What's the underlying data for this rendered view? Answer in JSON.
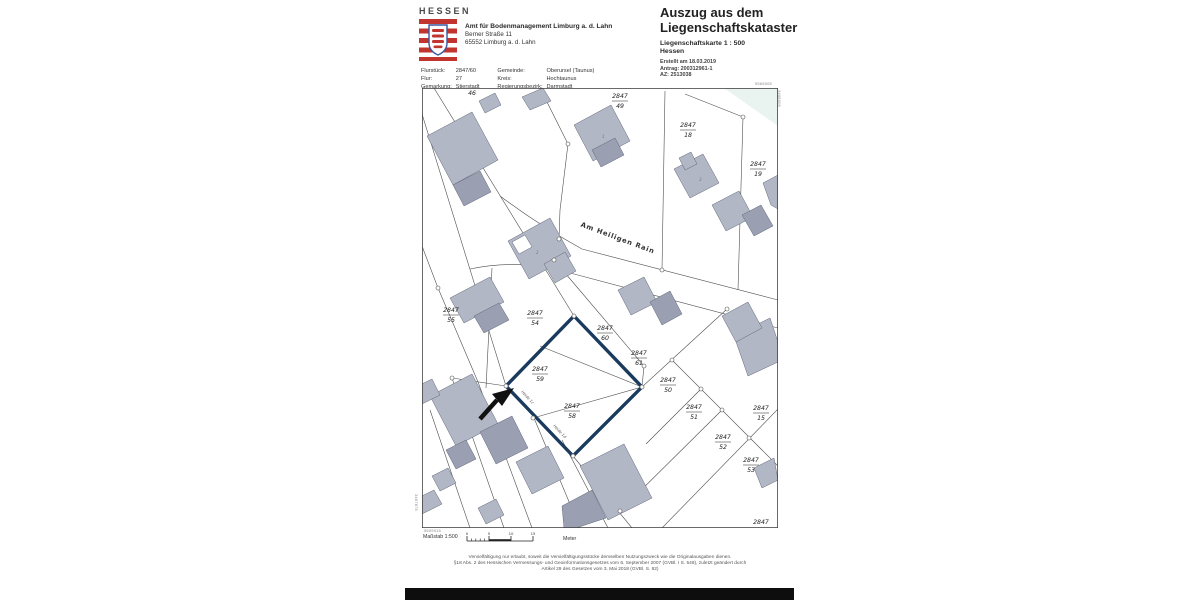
{
  "brand": {
    "wordmark": "HESSEN"
  },
  "office": {
    "name": "Amt für Bodenmanagement Limburg a. d. Lahn",
    "street": "Berner Straße 11",
    "city": "65552 Limburg a. d. Lahn"
  },
  "meta": {
    "rows": [
      {
        "l1": "Flurstück:",
        "v1": "2847/60",
        "l2": "Gemeinde:",
        "v2": "Oberursel (Taunus)"
      },
      {
        "l1": "Flur:",
        "v1": "27",
        "l2": "Kreis:",
        "v2": "Hochtaunus"
      },
      {
        "l1": "Gemarkung:",
        "v1": "Stierstadt",
        "l2": "Regierungsbezirk:",
        "v2": "Darmstadt"
      }
    ]
  },
  "title": {
    "line1": "Auszug aus dem",
    "line2": "Liegenschaftskataster",
    "subtitle": "Liegenschaftskarte  1 : 500",
    "region": "Hessen",
    "created": "Erstellt am 18.03.2019",
    "antrag": "Antrag: 200312961-1",
    "az": "AZ: 2513038"
  },
  "map": {
    "street_label": "Am Heiligen Rain",
    "highlight_color": "#1a3a5e",
    "building_color": "#b2b7c5",
    "building_dark_color": "#9aa0b2",
    "parcels": [
      {
        "num": "2847",
        "den": "49"
      },
      {
        "num": "2847",
        "den": "18"
      },
      {
        "num": "2847",
        "den": "19"
      },
      {
        "num": "2847",
        "den": "55"
      },
      {
        "num": "2847",
        "den": "54"
      },
      {
        "num": "2847",
        "den": "60"
      },
      {
        "num": "2847",
        "den": "61"
      },
      {
        "num": "2847",
        "den": "59"
      },
      {
        "num": "2847",
        "den": "50"
      },
      {
        "num": "2847",
        "den": "58"
      },
      {
        "num": "2847",
        "den": "51"
      },
      {
        "num": "2847",
        "den": "15"
      },
      {
        "num": "2847",
        "den": "52"
      },
      {
        "num": "2847",
        "den": "53"
      }
    ],
    "cut_labels": {
      "top": "46",
      "bottom": "2847"
    },
    "house_labels": [
      {
        "text": "Heide 1c"
      },
      {
        "text": "Heide 1d"
      }
    ],
    "house_numbers": [
      {
        "text": "1"
      },
      {
        "text": "2"
      },
      {
        "text": "3"
      }
    ],
    "corner_coords": {
      "top_right_h": "5565005",
      "top_right_v": "3468005",
      "bottom_left_h": "5509915",
      "bottom_left_v": "3467875"
    }
  },
  "footer": {
    "scale_label": "Maßstab 1:500",
    "scale_ticks": [
      "0",
      "5",
      "10",
      "15"
    ],
    "unit": "Meter",
    "legal": [
      "Vervielfältigung nur erlaubt, soweit die Vervielfältigungsstücke demselben Nutzungszweck wie die Originalausgaben dienen.",
      "§18 Abs. 2 des Hessischen Vermessungs- und Geoinformationsgesetzes vom 6. September 2007 (GVBl. I S. 548), zuletzt geändert durch",
      "Artikel 29 des Gesetzes vom 3. Mai 2018 (GVBl. S. 82)"
    ]
  }
}
